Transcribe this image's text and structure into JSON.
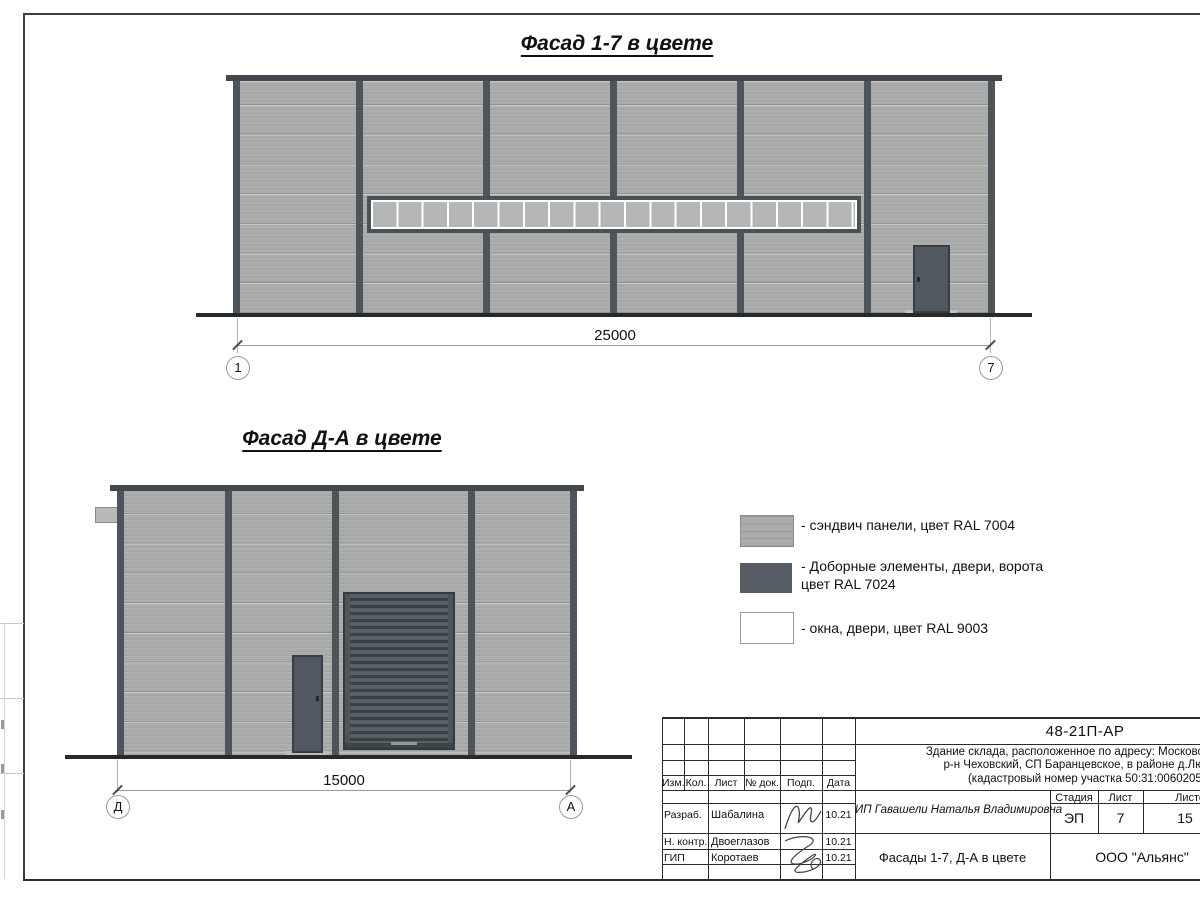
{
  "facade1": {
    "title": "Фасад 1-7 в цвете",
    "dimension_label": "25000",
    "axis_left": "1",
    "axis_right": "7",
    "window_pane_count": 19
  },
  "facade2": {
    "title": "Фасад Д-А в цвете",
    "dimension_label": "15000",
    "axis_left": "Д",
    "axis_right": "А"
  },
  "legend": {
    "items": [
      {
        "label": "- сэндвич панели, цвет RAL 7004",
        "label2": "",
        "swatch_color": "#a9acaa"
      },
      {
        "label": "- Доборные элементы, двери, ворота",
        "label2": "цвет RAL 7024",
        "swatch_color": "#565d64"
      },
      {
        "label": "- окна, двери, цвет RAL 9003",
        "label2": "",
        "swatch_color": "#ffffff"
      }
    ]
  },
  "title_block": {
    "doc_number": "48-21П-АР",
    "address_line1": "Здание склада, расположенное по адресу: Московская область,",
    "address_line2": "р-н Чеховский, СП Баранцевское, в районе д.Люторецкое",
    "address_line3": "(кадастровый номер участка 50:31:0060205:252)",
    "header_cols": [
      "Изм.",
      "Кол.",
      "Лист",
      "№ док.",
      "Подп.",
      "Дата"
    ],
    "stage_label": "Стадия",
    "sheet_label": "Лист",
    "sheets_label": "Листов",
    "stage_value": "ЭП",
    "sheet_value": "7",
    "sheets_value": "15",
    "client": "ИП Гавашели Наталья Владимировна",
    "rows": [
      {
        "role": "Разраб.",
        "name": "Шабалина",
        "date": "10.21"
      },
      {
        "role": "Н. контр.",
        "name": "Двоеглазов",
        "date": "10.21"
      },
      {
        "role": "ГИП",
        "name": "Коротаев",
        "date": "10.21"
      }
    ],
    "drawing_title": "Фасады 1-7, Д-А в цвете",
    "company": "ООО \"Альянс\""
  }
}
